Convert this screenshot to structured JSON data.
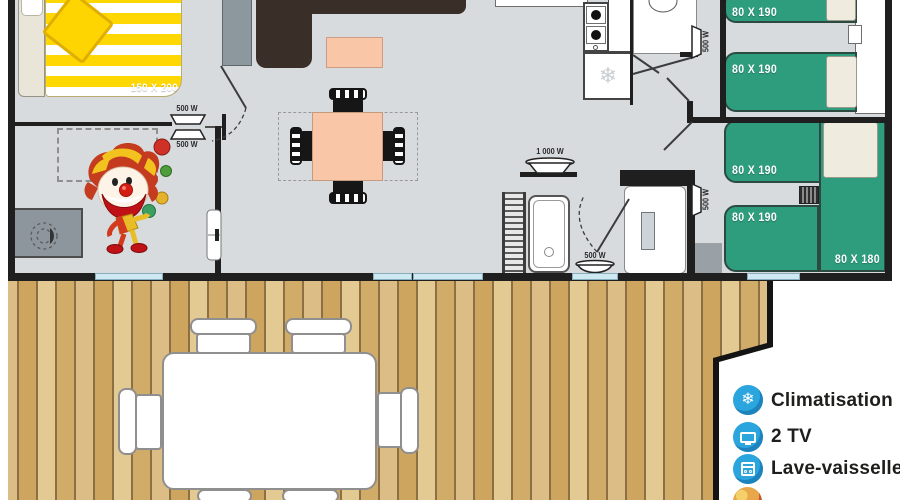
{
  "plan": {
    "beds": {
      "master": "150 X 200",
      "single_labels": [
        "80 X 190",
        "80 X 190",
        "80 X 190",
        "80 X 190"
      ],
      "corner": "80 X 180"
    },
    "radiator_labels": {
      "master_above": "500 W",
      "master_below": "500 W",
      "hall_upper": "500 W",
      "hall_lower": "500 W",
      "bathroom_large": "1 000 W",
      "bathroom_small": "500 W"
    }
  },
  "legend": {
    "items": [
      {
        "icon": "snowflake-icon",
        "label": "Climatisation"
      },
      {
        "icon": "tv-icon",
        "label": "2 TV"
      },
      {
        "icon": "dishwasher-icon",
        "label": "Lave-vaisselle"
      },
      {
        "icon": "clown-icon",
        "label": ""
      }
    ]
  },
  "colors": {
    "bed_green": "#2e9d7e",
    "accent_blue": "#2aa5de",
    "peach": "#f9c7a7",
    "bed_yellow": "#ffd400",
    "wood": "#d2ad6c",
    "wall": "#1f1f1f",
    "window": "#cfe9f2"
  }
}
